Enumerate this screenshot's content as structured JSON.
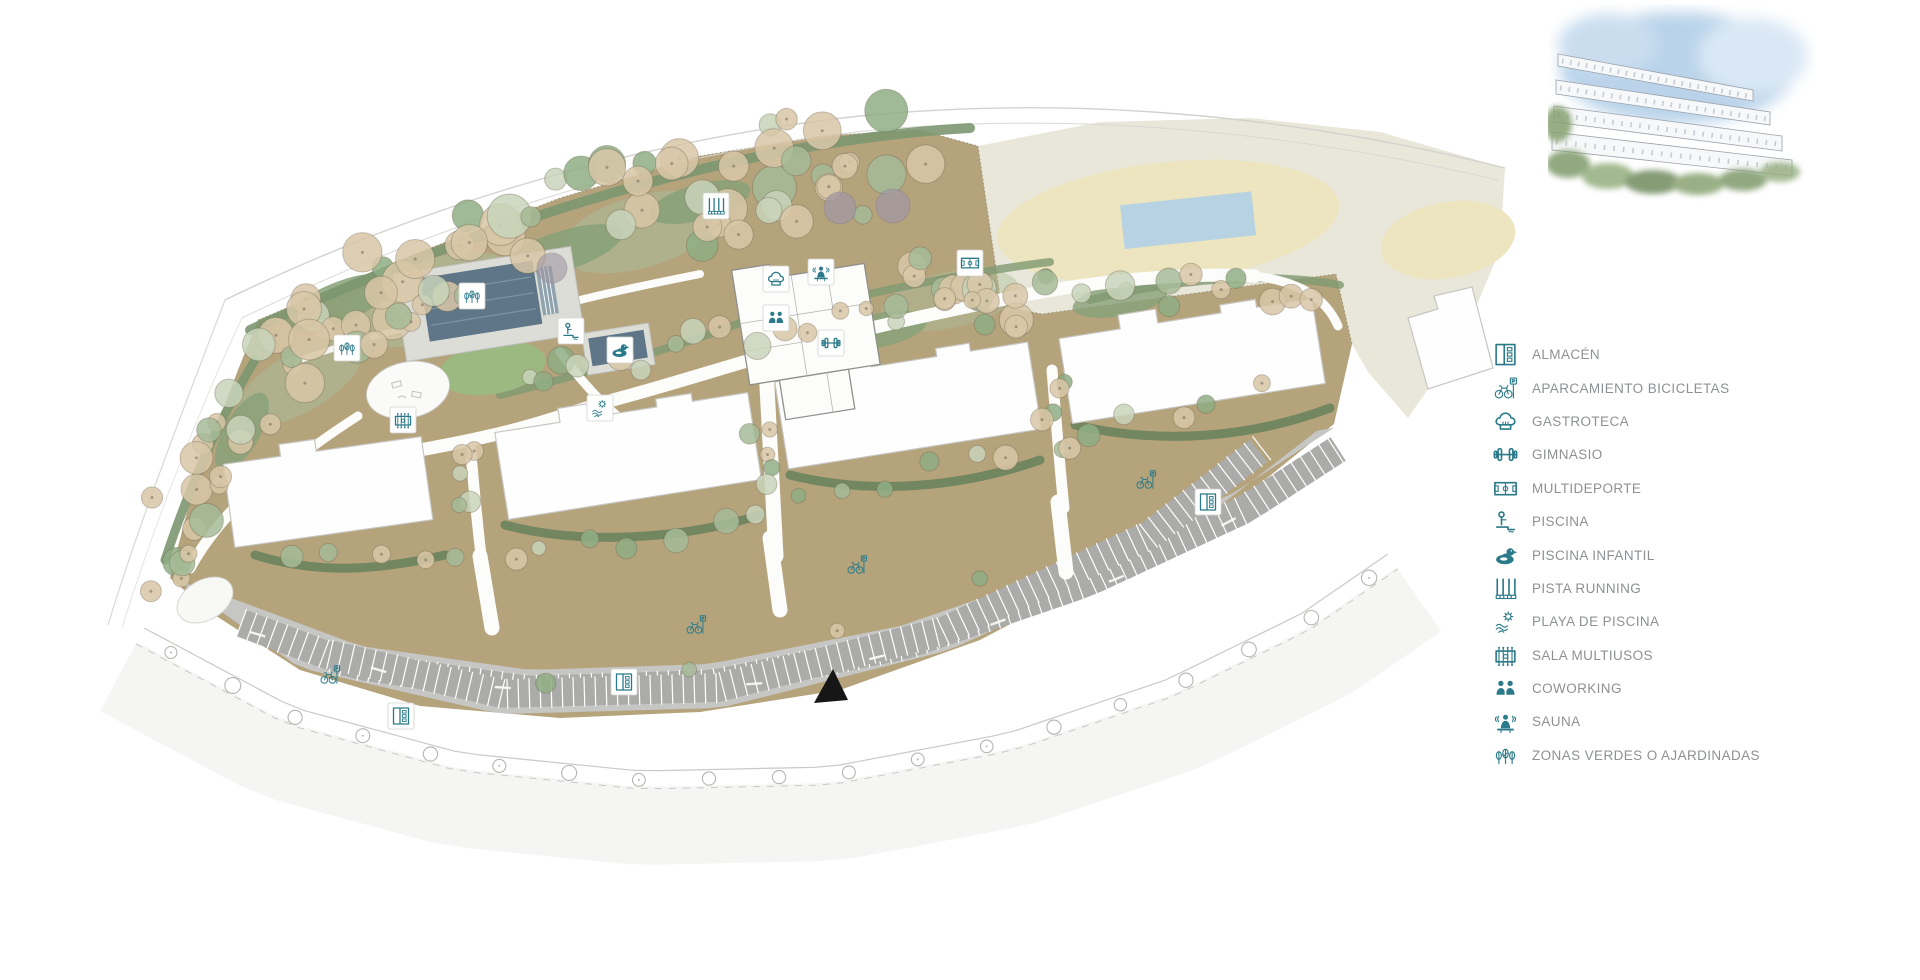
{
  "page": {
    "background": "#ffffff"
  },
  "colors": {
    "icon_teal": "#2b7a89",
    "legend_text": "#8d9194",
    "ground_tan": "#b5a37c",
    "green_strip": "#87a178",
    "cream_field": "#e9e7d9",
    "yellow_oval": "#ece5bf",
    "water_blue": "#b7d2e2",
    "pool_dark": "#5e7687",
    "parking_gray": "#c6c6c4",
    "stall_gray": "#ababa9",
    "building_white": "#ffffff"
  },
  "legend": {
    "items": [
      {
        "id": "almacen",
        "icon": "almacen",
        "label": "ALMACÉN"
      },
      {
        "id": "aparcamiento-bicicletas",
        "icon": "bicicletas",
        "label": "APARCAMIENTO BICICLETAS"
      },
      {
        "id": "gastroteca",
        "icon": "gastroteca",
        "label": "GASTROTECA"
      },
      {
        "id": "gimnasio",
        "icon": "gimnasio",
        "label": "GIMNASIO"
      },
      {
        "id": "multideporte",
        "icon": "multideporte",
        "label": "MULTIDEPORTE"
      },
      {
        "id": "piscina",
        "icon": "piscina",
        "label": "PISCINA"
      },
      {
        "id": "piscina-infantil",
        "icon": "piscina-infantil",
        "label": "PISCINA INFANTIL"
      },
      {
        "id": "pista-running",
        "icon": "pista-running",
        "label": "PISTA RUNNING"
      },
      {
        "id": "playa-de-piscina",
        "icon": "playa-piscina",
        "label": "PLAYA DE PISCINA"
      },
      {
        "id": "sala-multiusos",
        "icon": "sala-multiusos",
        "label": "SALA MULTIUSOS"
      },
      {
        "id": "coworking",
        "icon": "coworking",
        "label": "COWORKING"
      },
      {
        "id": "sauna",
        "icon": "sauna",
        "label": "SAUNA"
      },
      {
        "id": "zonas-verdes",
        "icon": "zonas-verdes",
        "label": "ZONAS VERDES O AJARDINADAS"
      }
    ]
  },
  "map": {
    "markers": [
      {
        "icon": "zonas-verdes",
        "x": 472,
        "y": 296
      },
      {
        "icon": "zonas-verdes",
        "x": 347,
        "y": 348
      },
      {
        "icon": "piscina",
        "x": 571,
        "y": 331
      },
      {
        "icon": "piscina-infantil",
        "x": 620,
        "y": 350
      },
      {
        "icon": "playa-piscina",
        "x": 600,
        "y": 408
      },
      {
        "icon": "pista-running",
        "x": 716,
        "y": 206
      },
      {
        "icon": "gastroteca",
        "x": 776,
        "y": 279
      },
      {
        "icon": "sauna",
        "x": 821,
        "y": 272
      },
      {
        "icon": "coworking",
        "x": 776,
        "y": 318
      },
      {
        "icon": "gimnasio",
        "x": 831,
        "y": 343
      },
      {
        "icon": "multideporte",
        "x": 970,
        "y": 263
      },
      {
        "icon": "sala-multiusos",
        "x": 403,
        "y": 420
      },
      {
        "icon": "almacen",
        "x": 401,
        "y": 716
      },
      {
        "icon": "almacen",
        "x": 624,
        "y": 682
      },
      {
        "icon": "almacen",
        "x": 1208,
        "y": 502
      },
      {
        "icon": "bicicletas",
        "x": 330,
        "y": 675,
        "box": false
      },
      {
        "icon": "bicicletas",
        "x": 696,
        "y": 625,
        "box": false
      },
      {
        "icon": "bicicletas",
        "x": 857,
        "y": 565,
        "box": false
      },
      {
        "icon": "bicicletas",
        "x": 1146,
        "y": 480,
        "box": false
      }
    ]
  }
}
